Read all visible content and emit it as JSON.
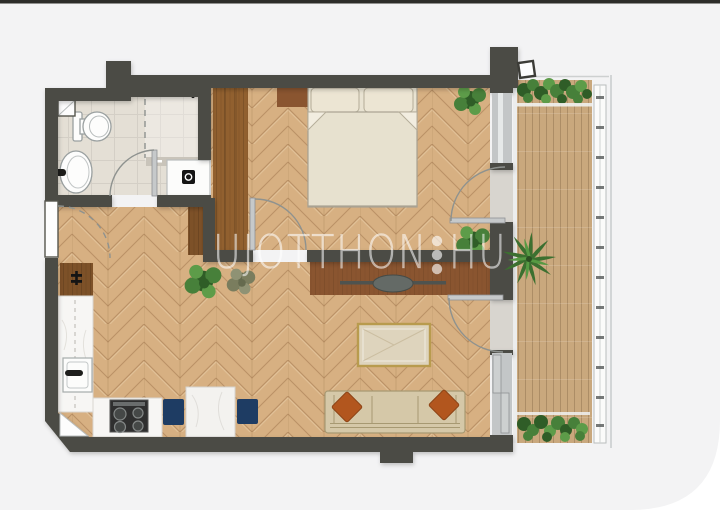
{
  "page": {
    "background": "#ffffff",
    "card_bg": "#f3f3f4",
    "top_edge": "#2d2d29",
    "corner_radius_px": 90
  },
  "watermark": {
    "part1": "UJOTTHON",
    "part2": "HU",
    "separator": "three-vertical-dots",
    "color": "#ffffff",
    "opacity": 0.55
  },
  "palette": {
    "wall": "#4c4c45",
    "parquet": "#d7b082",
    "tile": "#e4dfd5",
    "deck": "#c9a87d",
    "wood_console": "#8a5530",
    "wood_wardrobe": "#91602f",
    "wood_closet": "#7d5128",
    "bed_linen": "#e9e3d2",
    "sofa_fabric": "#d5c8a8",
    "pillow_rust": "#b2561e",
    "chair_navy": "#1e3c63",
    "glass": "#c3c6c7",
    "table_gold": "#b89b4e",
    "plant_green": "#47803a",
    "wm_color": "#ffffff"
  },
  "floorplan": {
    "rooms": [
      {
        "name": "bathroom"
      },
      {
        "name": "hallway"
      },
      {
        "name": "bedroom"
      },
      {
        "name": "living-room-kitchen"
      },
      {
        "name": "terrace"
      }
    ],
    "furniture": [
      "toilet",
      "bathroom-sink",
      "shower",
      "washing-machine",
      "entrance-door",
      "wardrobe",
      "nightstand",
      "double-bed",
      "hallway-closet",
      "fridge-cabinet",
      "kitchen-counter",
      "kitchen-sink",
      "cooktop",
      "dining-table",
      "dining-chairs",
      "tv-sideboard",
      "tv",
      "coffee-table",
      "sofa",
      "sofa-pillows",
      "plants",
      "palm-plant",
      "planter-boxes",
      "deck-flooring",
      "railing",
      "glass-doors"
    ]
  }
}
